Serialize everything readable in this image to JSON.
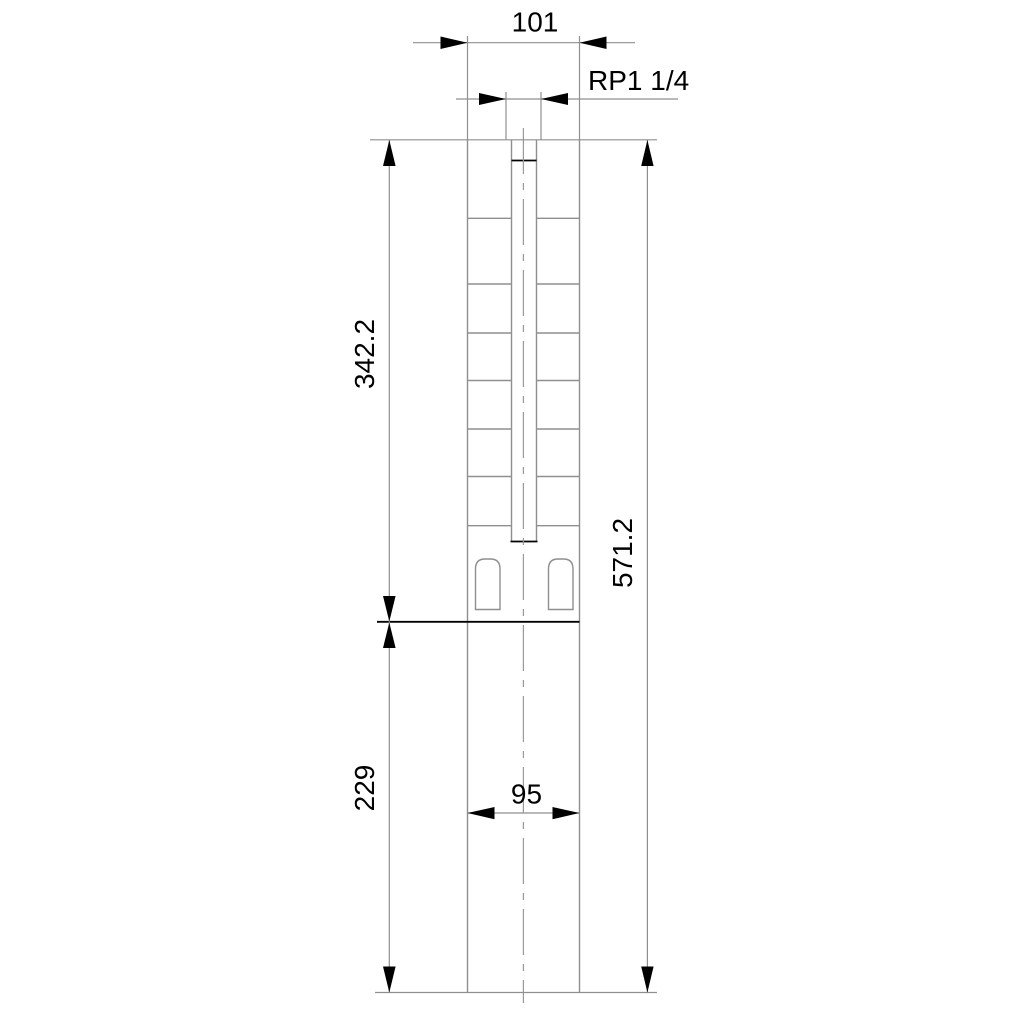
{
  "drawing": {
    "type": "technical-dimensional-drawing",
    "subject": "submersible-borehole-pump-outline",
    "background_color": "#ffffff",
    "colors": {
      "outline_gray": "#8f8f8f",
      "edge_black": "#000000",
      "text": "#000000"
    },
    "dimensions": {
      "outlet_width": "101",
      "thread_size": "RP1 1/4",
      "pump_length": "342.2",
      "total_length": "571.2",
      "motor_length": "229",
      "motor_diameter": "95"
    }
  }
}
